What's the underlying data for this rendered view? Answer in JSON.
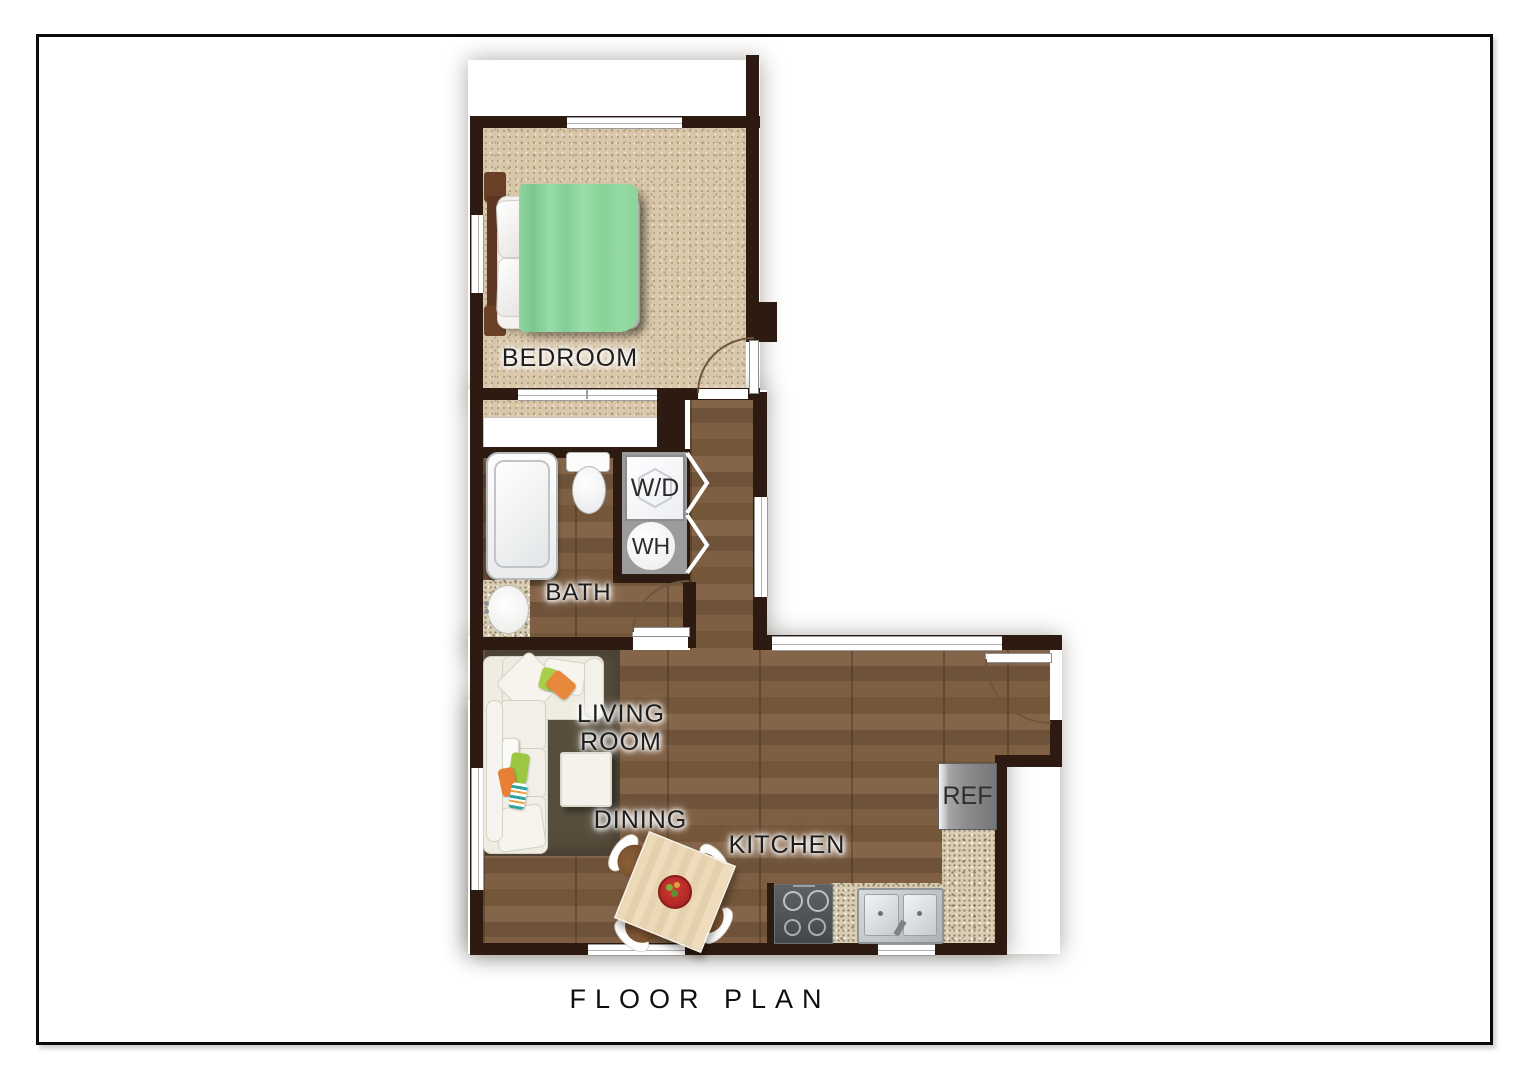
{
  "title": "FLOOR PLAN",
  "rooms": {
    "bedroom": {
      "label": "BEDROOM"
    },
    "bath": {
      "label": "BATH"
    },
    "living_room": {
      "line1": "LIVING",
      "line2": "ROOM"
    },
    "dining": {
      "label": "DINING"
    },
    "kitchen": {
      "label": "KITCHEN"
    }
  },
  "fixtures": {
    "washer_dryer": {
      "label": "W/D"
    },
    "water_heater": {
      "label": "WH"
    },
    "refrigerator": {
      "label": "REF"
    }
  },
  "colors": {
    "wall": "#2d1a10",
    "carpet": "#d9c7a9",
    "wood_floor": "#7b5c3e",
    "granite_counter": "#d9cdb4",
    "rug": "#564d3c",
    "blanket_green": "#92d8a2",
    "appliance_pad_gray": "#9b9b9b",
    "stove_gray": "#4a4d50",
    "label_text": "#1d1d1d"
  }
}
